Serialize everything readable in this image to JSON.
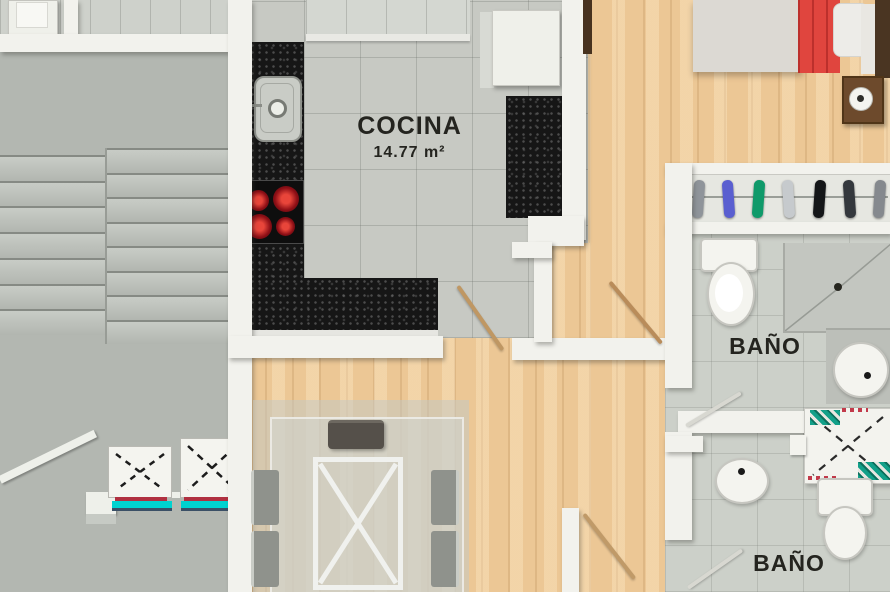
{
  "plan_type": "apartment-floor-plan-render",
  "labels": {
    "kitchen_name": "COCINA",
    "kitchen_area": "14.77 m²",
    "bath1": "BAÑO",
    "bath2": "BAÑO",
    "closet": "cl"
  },
  "stairs": {
    "left_steps": 7,
    "right_steps": 8
  },
  "closet": {
    "clothes_colors": [
      "#8f949a",
      "#5a5fd0",
      "#0f9a6a",
      "#c6cacd",
      "#141618",
      "#34383d",
      "#85898e"
    ]
  },
  "colors": {
    "wood_floor": "#ecc795",
    "kitchen_tile": "#c7c9c3",
    "bath_tile": "#ccd0c9",
    "stair_gray": "#b3b7b1",
    "wall_white": "#f2f2ed",
    "counter_granite": "#161616",
    "burner_red": "#d02028",
    "bed_blanket_red": "#e0453e",
    "elevator_door_cyan": "#00d2d0",
    "duct_hatch_teal": "#12a089"
  }
}
